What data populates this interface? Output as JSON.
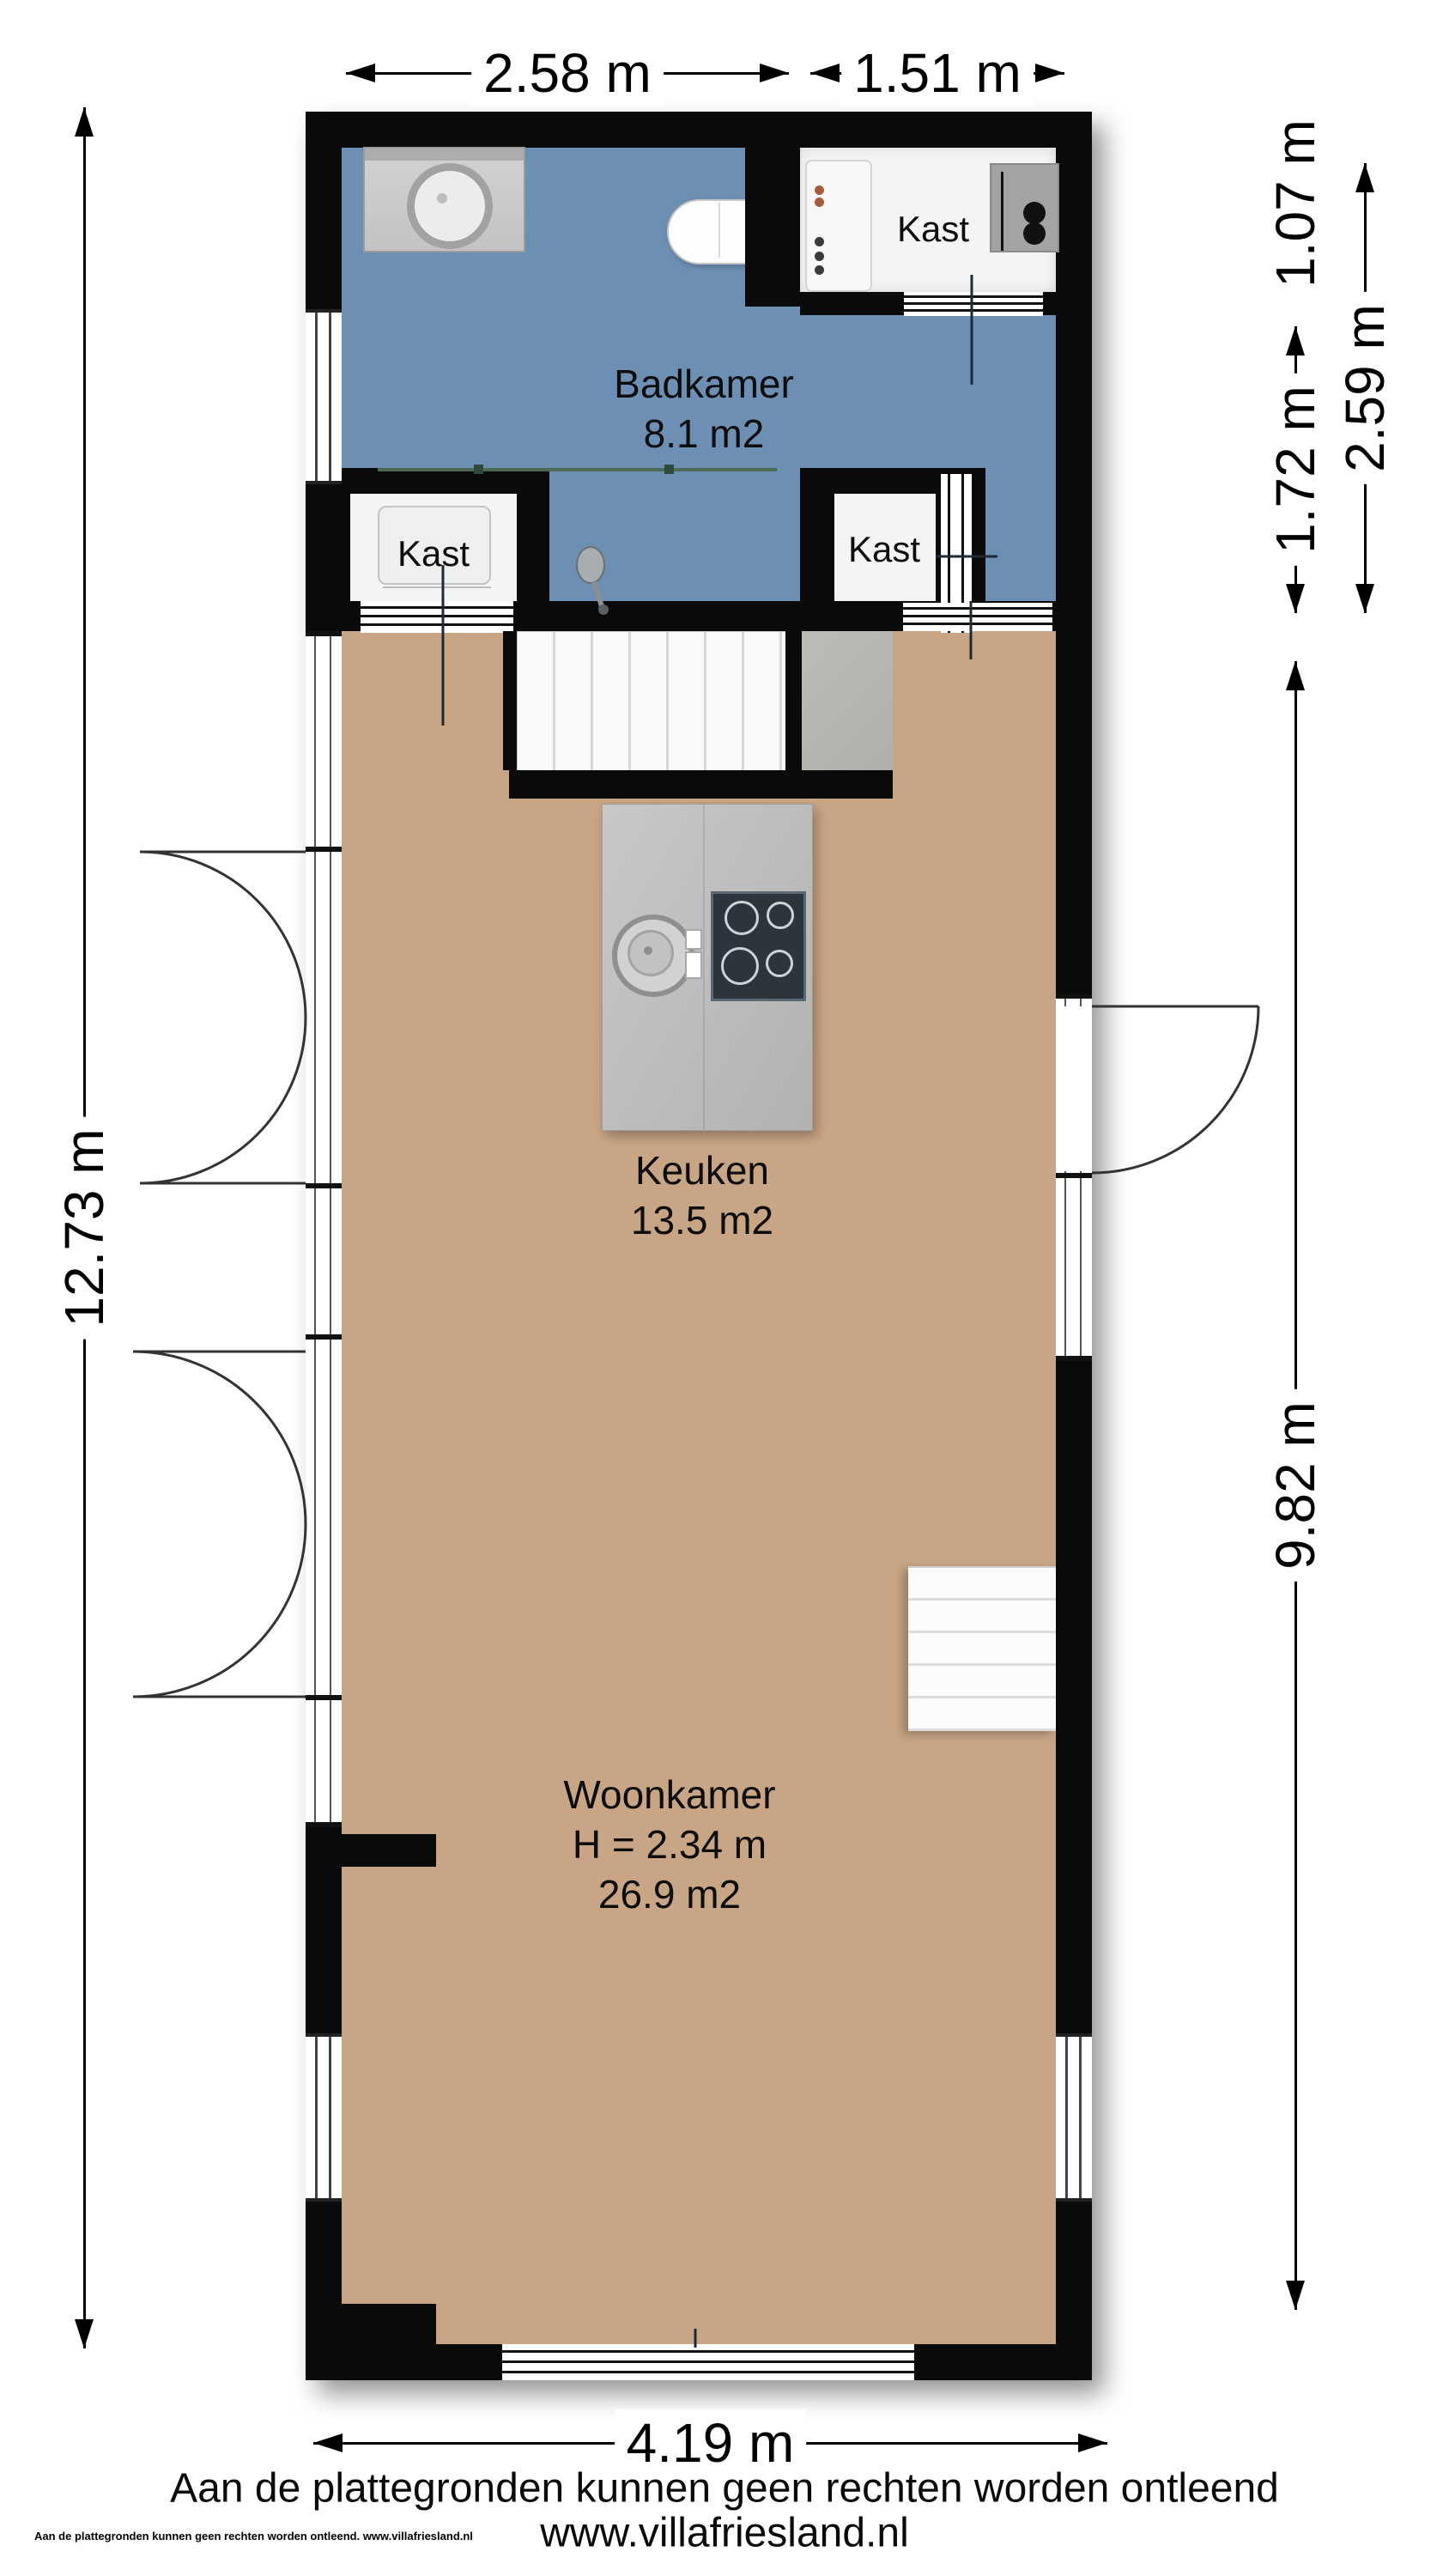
{
  "rooms": {
    "badkamer": {
      "label": "Badkamer",
      "area": "8.1 m2"
    },
    "keuken": {
      "label": "Keuken",
      "area": "13.5 m2"
    },
    "woonkamer": {
      "label": "Woonkamer",
      "height": "H = 2.34 m",
      "area": "26.9 m2"
    },
    "kast_top": {
      "label": "Kast"
    },
    "kast_left": {
      "label": "Kast"
    },
    "kast_right": {
      "label": "Kast"
    }
  },
  "dimensions": {
    "top_width_left": "2.58 m",
    "top_width_right": "1.51 m",
    "right_top": "1.07 m",
    "right_upper": "2.59 m",
    "right_mid": "1.72 m",
    "right_main": "9.82 m",
    "left_total": "12.73 m",
    "bottom_width": "4.19 m"
  },
  "footer": {
    "disclaimer": "Aan de plattegronden kunnen geen rechten worden ontleend",
    "website": "www.villafriesland.nl",
    "watermark": "Aan de plattegronden kunnen geen rechten worden ontleend. www.villafriesland.nl"
  },
  "colors": {
    "wall": "#0a0a0a",
    "bathroom_floor": "#6d8fb4",
    "living_floor": "#c8a585",
    "island_gray": "#bfbfbf",
    "landing_gray": "#b6b6b0",
    "cooktop": "#2e343c",
    "closet_fill": "#f4f4f4"
  }
}
